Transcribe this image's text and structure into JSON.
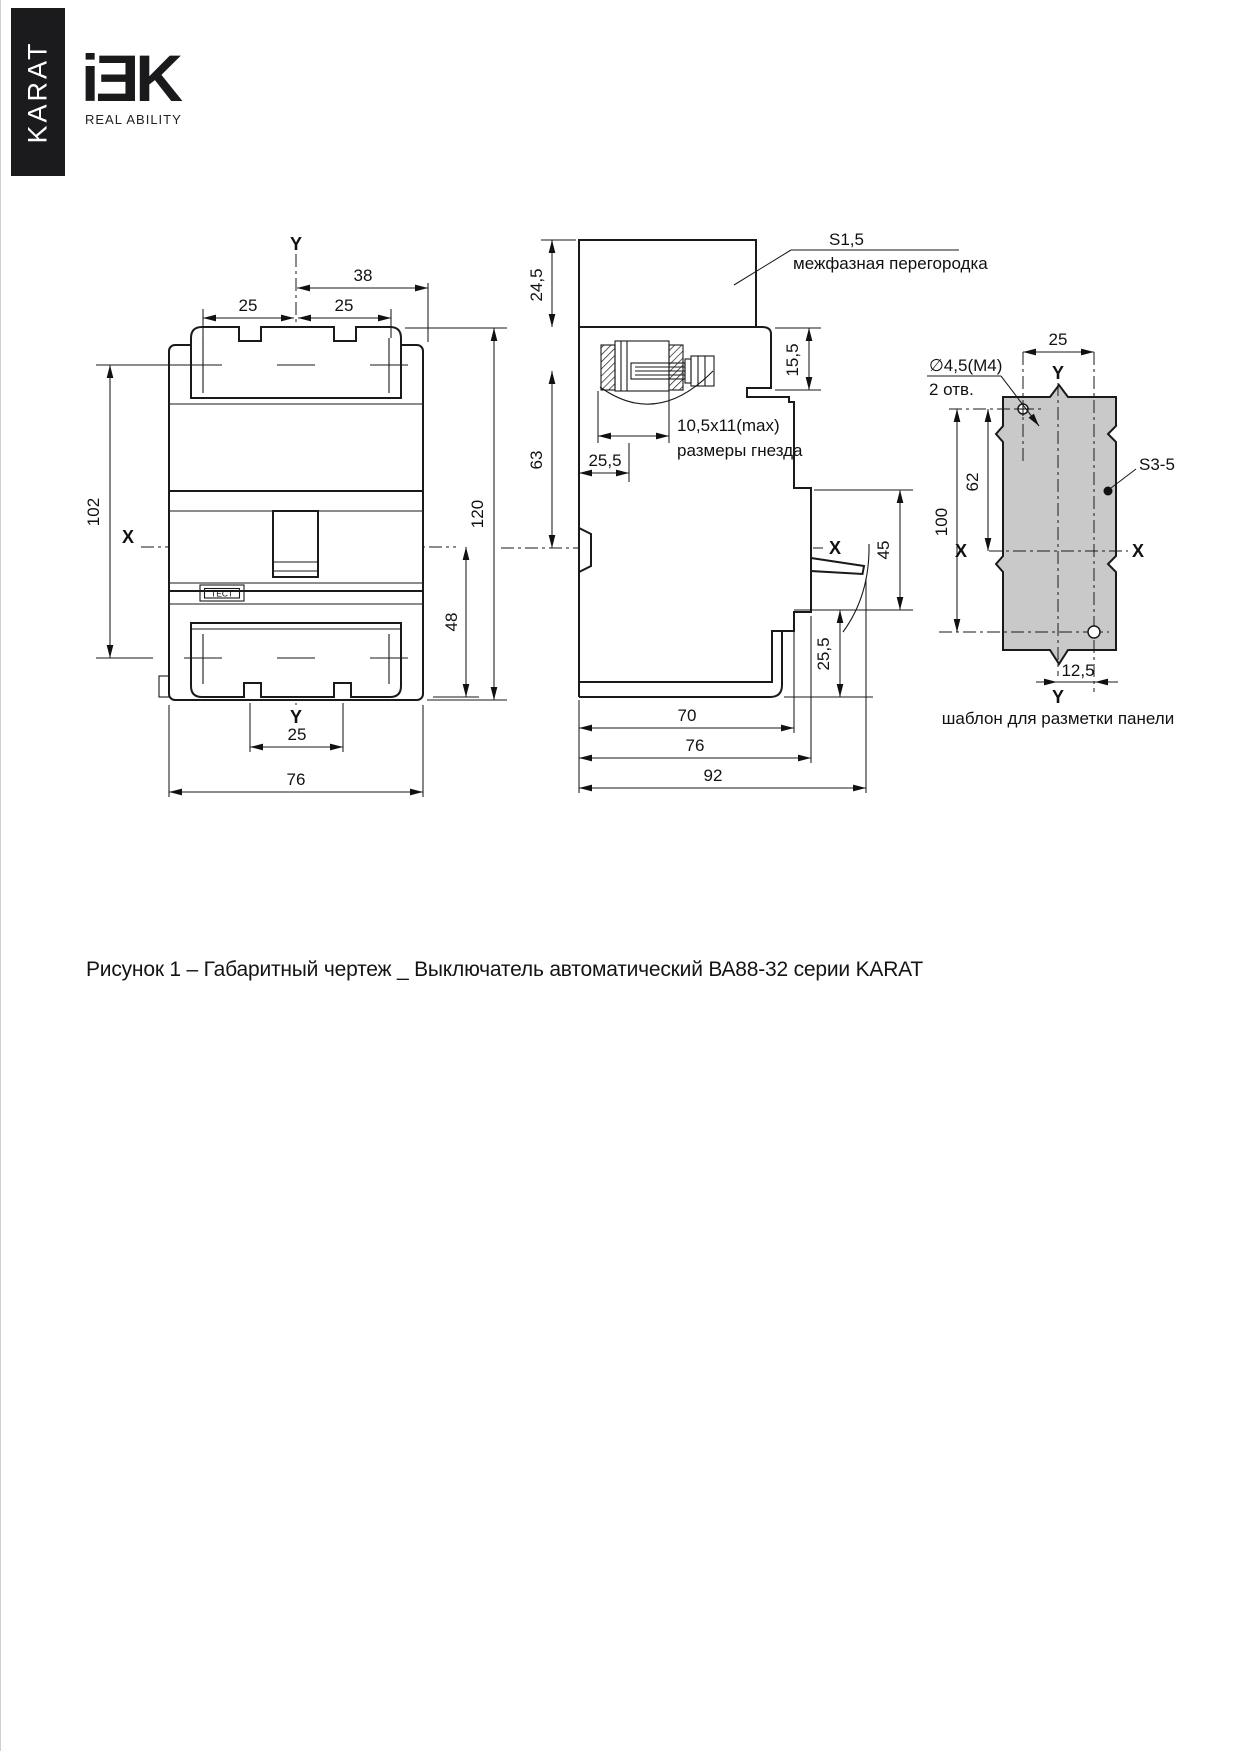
{
  "brand": {
    "series": "KARAT",
    "logo": "iƎK",
    "tagline": "REAL ABILITY"
  },
  "figure_caption": "Рисунок 1 – Габаритный чертеж _ Выключатель автоматический ВА88-32 серии KARAT",
  "front": {
    "y_top": "Y",
    "y_bottom": "Y",
    "x_axis": "X",
    "d38": "38",
    "d25l": "25",
    "d25r": "25",
    "d102": "102",
    "d120": "120",
    "d48": "48",
    "d25b": "25",
    "d76": "76",
    "test": "ТЕСТ"
  },
  "side": {
    "d245": "24,5",
    "s15": "S1,5",
    "partition": "межфазная перегородка",
    "d155": "15,5",
    "d63": "63",
    "socket_dim": "10,5x11(max)",
    "socket_txt": "размеры гнезда",
    "d255t": "25,5",
    "x_axis": "X",
    "d45": "45",
    "d255b": "25,5",
    "d70": "70",
    "d76": "76",
    "d92": "92"
  },
  "panel": {
    "d25": "25",
    "y_top": "Y",
    "y_bottom": "Y",
    "x_left": "X",
    "x_right": "X",
    "hole1": "∅4,5(M4)",
    "hole2": "2 отв.",
    "d62": "62",
    "d100": "100",
    "s35": "S3-5",
    "d125": "12,5",
    "caption": "шаблон для разметки панели"
  }
}
